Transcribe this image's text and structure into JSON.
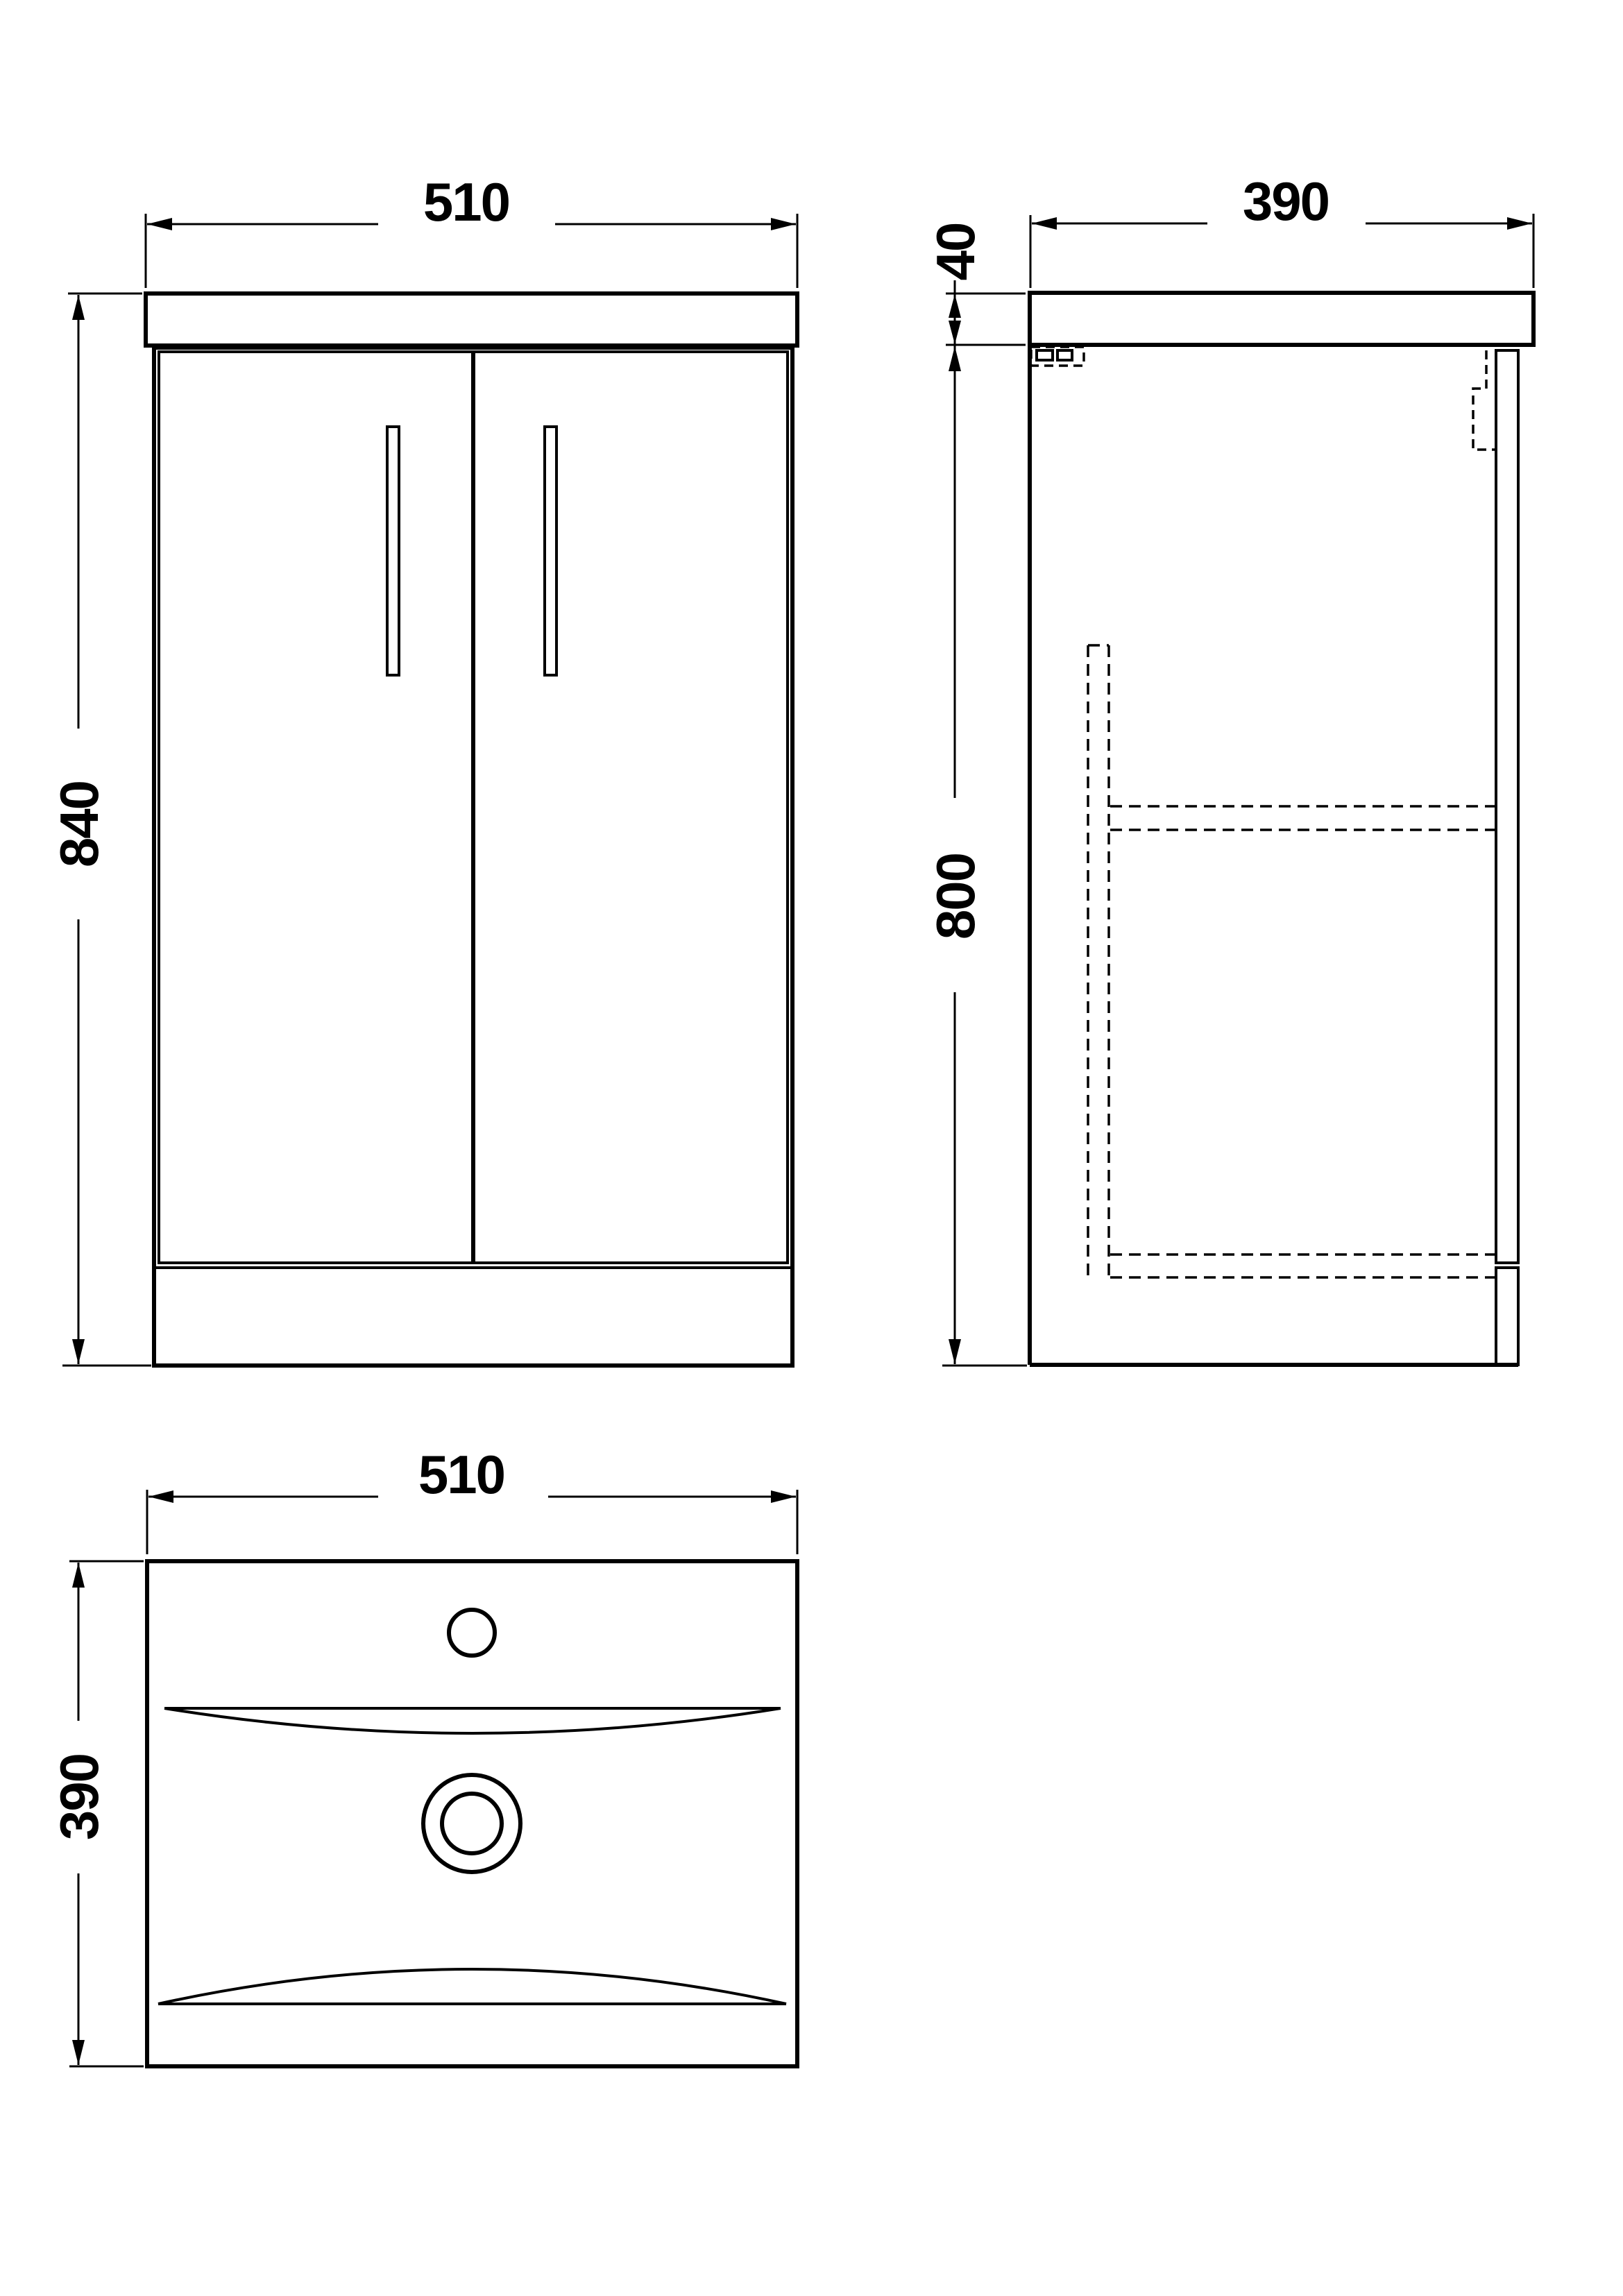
{
  "drawing": {
    "views": {
      "front": {
        "label": "front-elevation",
        "width_mm": "510",
        "height_mm": "840"
      },
      "side": {
        "label": "side-elevation",
        "depth_mm": "390",
        "worktop_thickness_mm": "40",
        "cabinet_height_mm": "800"
      },
      "plan": {
        "label": "basin-plan",
        "width_mm": "510",
        "depth_mm": "390"
      }
    },
    "style": {
      "line_color": "#000000",
      "background": "#ffffff"
    }
  }
}
